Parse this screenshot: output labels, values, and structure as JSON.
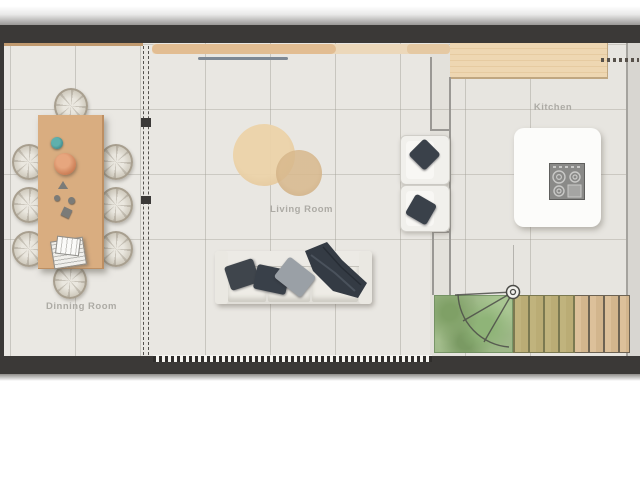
{
  "floorplan": {
    "rooms": {
      "dining": {
        "label": "Dinning Room"
      },
      "living": {
        "label": "Living Room"
      },
      "kitchen": {
        "label": "Kitchen"
      }
    },
    "furniture": [
      "dining-table",
      "dining-chairs-x8",
      "fruit-bowl",
      "vase",
      "book-stack",
      "round-wood-rug-large",
      "round-wood-rug-small",
      "three-seat-sofa",
      "throw-pillows",
      "throw-blanket",
      "wall-tv",
      "sideboard",
      "armchair-x2",
      "kitchen-counter",
      "kitchen-island",
      "cooktop",
      "staircase",
      "planting-bed",
      "door-swing",
      "sliding-partition",
      "window-band"
    ],
    "colors": {
      "wall": "#3b3937",
      "floor": "#eae8e3",
      "sideboard_wood": "#e2bd92",
      "table_wood": "#d9ad80",
      "counter_wood": "#eed7b2",
      "stairs_wood": "#d9bd95",
      "greenery": "#9db787",
      "cushion_dark": "#3a414a",
      "island_white": "#fcfcfa",
      "label_text": "#adaba5"
    }
  }
}
